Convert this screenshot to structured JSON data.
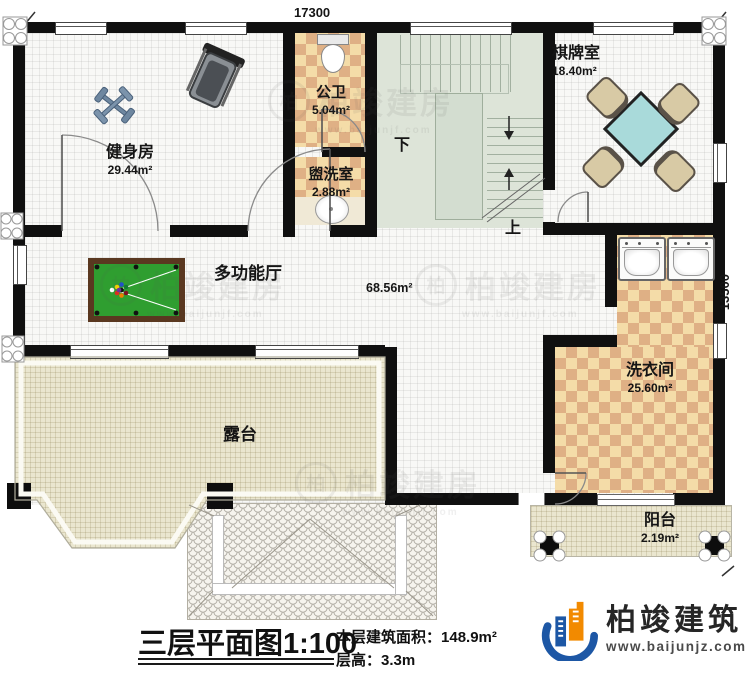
{
  "dimensions": {
    "width": "17300",
    "height": "13500"
  },
  "rooms": {
    "gym": {
      "name": "健身房",
      "area": "29.44m²"
    },
    "public_bath": {
      "name": "公卫",
      "area": "5.04m²"
    },
    "washroom": {
      "name": "盥洗室",
      "area": "2.88m²"
    },
    "chess": {
      "name": "棋牌室",
      "area": "18.40m²"
    },
    "hall": {
      "name": "多功能厅",
      "area": "68.56m²"
    },
    "laundry": {
      "name": "洗衣间",
      "area": "25.60m²"
    },
    "terrace": {
      "name": "露台"
    },
    "balcony": {
      "name": "阳台",
      "area": "2.19m²"
    }
  },
  "stairs": {
    "up": "上",
    "down": "下"
  },
  "footer": {
    "title": "三层平面图",
    "scale": "1:100",
    "area_label": "本层建筑面积：",
    "area_value": "148.9m²",
    "floor_height_label": "层高：",
    "floor_height_value": "3.3m"
  },
  "brand": {
    "name": "柏竣建筑",
    "website": "www.baijunjz.com"
  },
  "watermark": {
    "text": "柏竣建房",
    "website": "www.baijunjf.com"
  },
  "colors": {
    "wall": "#101010",
    "stairs_floor": "#dde4d8",
    "tile_light": "#f4dca8",
    "tile_dark": "#dfb085",
    "terrace": "#eae6cf",
    "felt_green": "#2f9e30",
    "table_cyan": "#a9dada",
    "brand_blue": "#1d57a5",
    "brand_orange": "#f28a00"
  }
}
